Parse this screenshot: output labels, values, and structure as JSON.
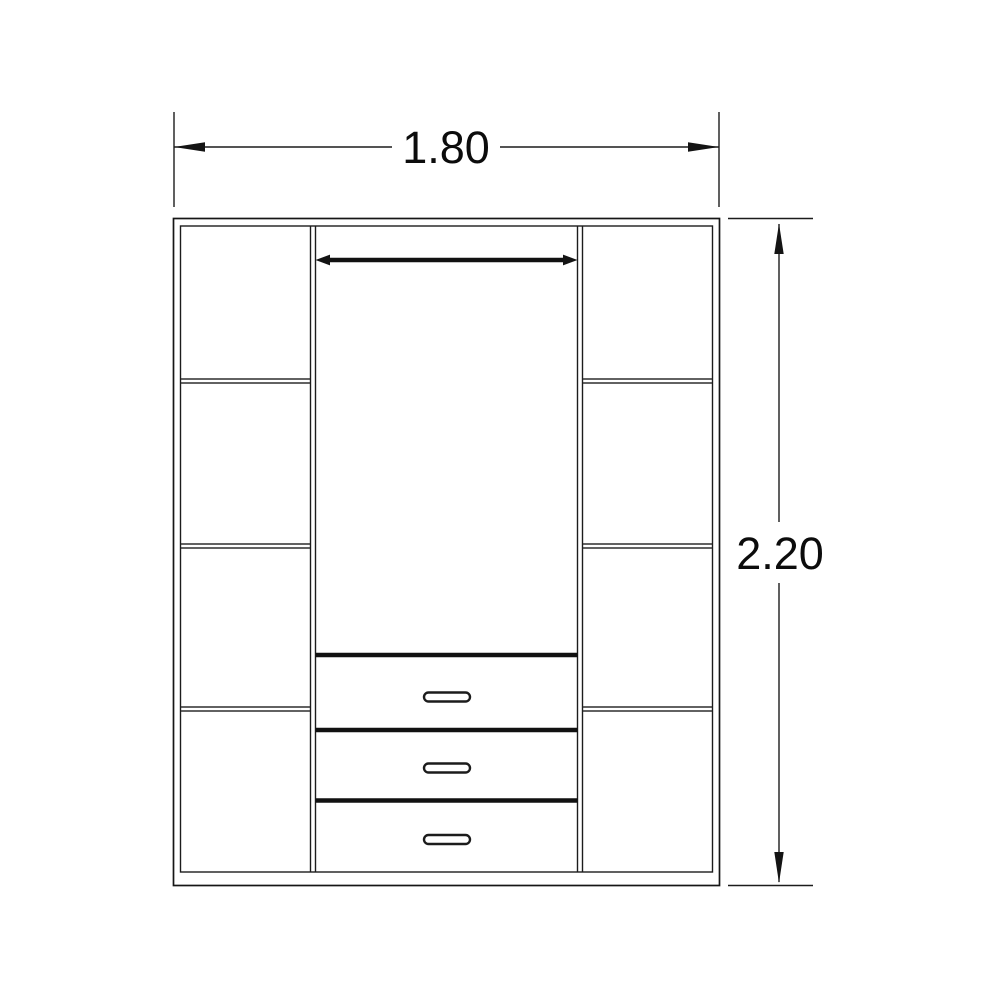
{
  "drawing": {
    "kind": "furniture-front-elevation",
    "subject": "wardrobe with side shelf columns, hanging rail and three drawers",
    "dimensions": {
      "width_label": "1.80",
      "height_label": "2.20"
    },
    "structure": {
      "left_column_compartments": 4,
      "right_column_compartments": 4,
      "shelves_per_side": 3,
      "drawer_count": 3,
      "drawer_handles": 3,
      "hanging_rail": true
    },
    "colors": {
      "line": "#1c1c1c",
      "background": "#ffffff",
      "text": "#0c0c0c"
    }
  }
}
